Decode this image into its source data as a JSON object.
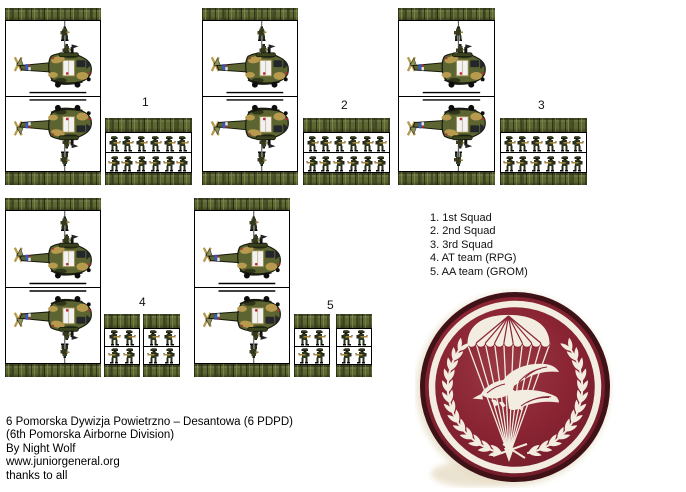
{
  "sheet": {
    "description": "Paper miniatures sheet: helicopter stands and infantry squad blocks"
  },
  "unit_labels": {
    "u1": "1",
    "u2": "2",
    "u3": "3",
    "u4": "4",
    "u5": "5"
  },
  "legend": {
    "items": [
      "1. 1st Squad",
      "2. 2nd Squad",
      "3. 3rd Squad",
      "4. AT team (RPG)",
      "5. AA team (GROM)"
    ]
  },
  "credits": {
    "lines": [
      "6 Pomorska Dywizja Powietrzno – Desantowa (6 PDPD)",
      "(6th Pomorska Airborne Division)",
      "By Night Wolf",
      "www.juniorgeneral.org",
      "thanks to all"
    ]
  },
  "figures": {
    "squad_row_count": 6,
    "team_row_count": 2,
    "rows_per_block": 2
  },
  "colors": {
    "camo_base": "#5d6732",
    "camo_dark": "#2f3519",
    "camo_light": "#8e9752",
    "heli_olive": "#5c6531",
    "heli_khaki": "#b79a4e",
    "emblem_maroon": "#8a2433",
    "emblem_dark_edge": "#3f1218",
    "emblem_white": "#f3ece0"
  },
  "emblem": {
    "name": "6th Pomorska Airborne Division insignia (parachute, diving eagle, laurel wreath)"
  }
}
